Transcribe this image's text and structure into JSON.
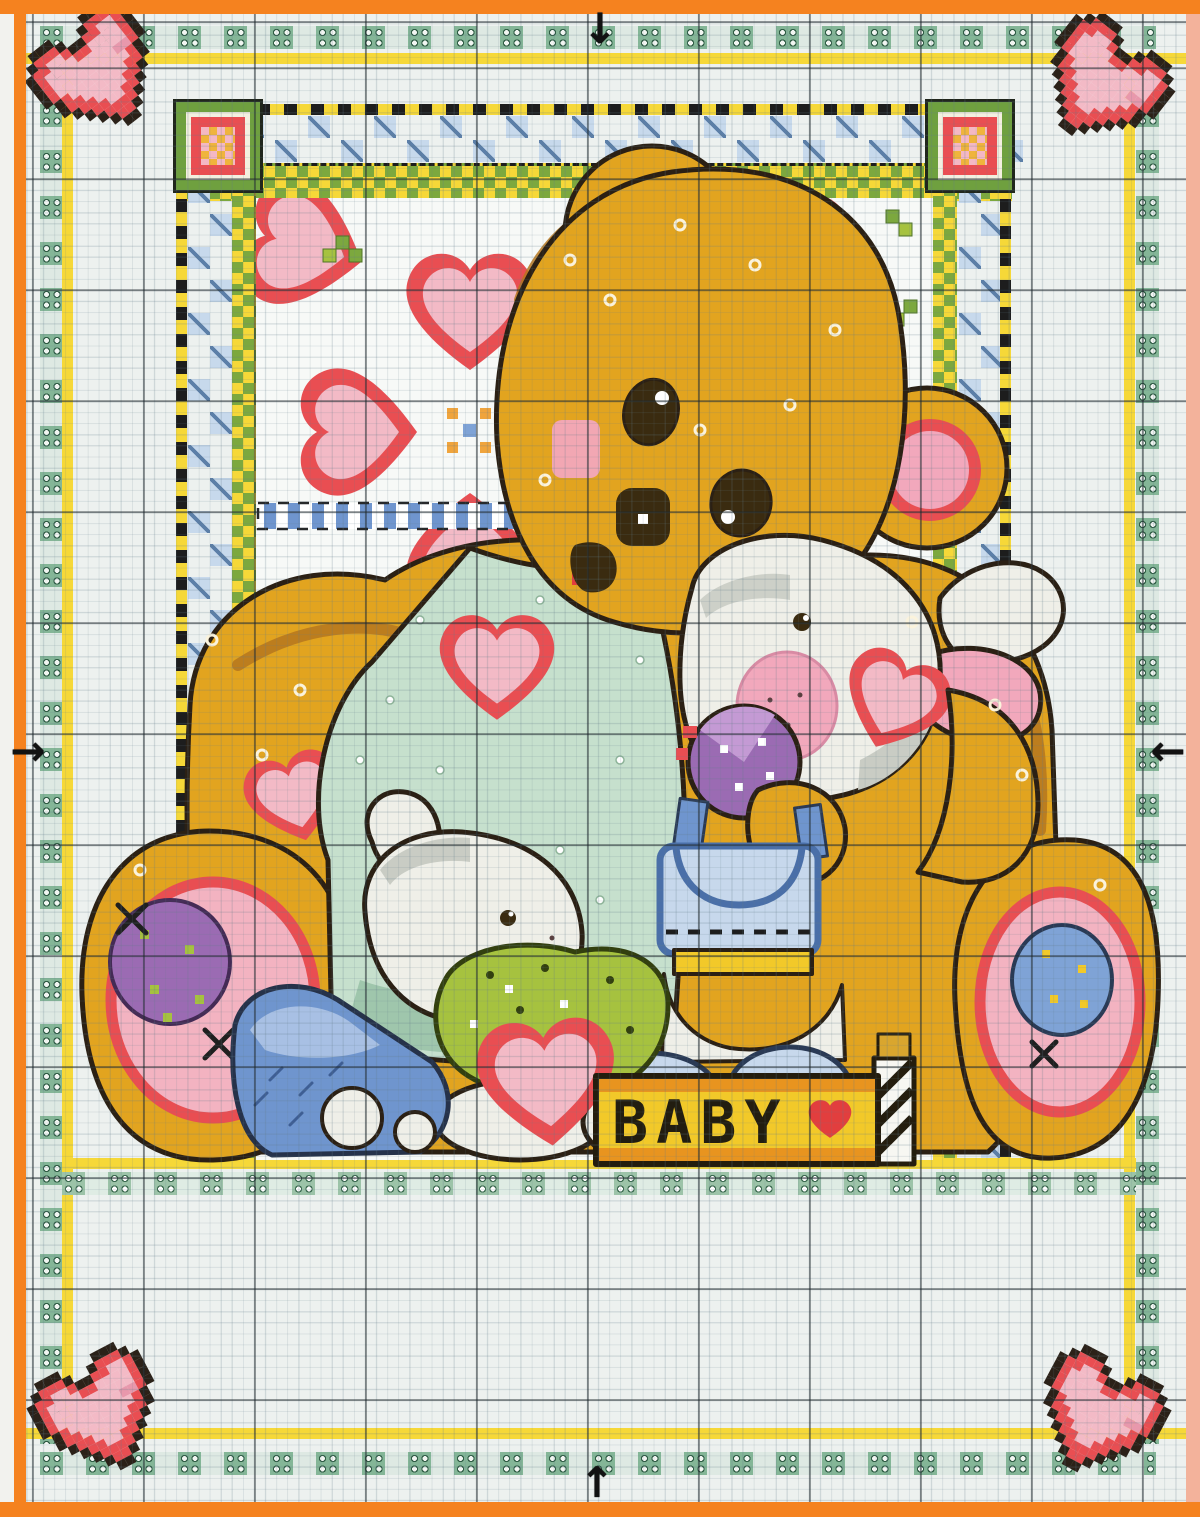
{
  "label_block": {
    "text": "BABY",
    "symbol": "red-heart"
  },
  "palette": {
    "orange": "#f5821f",
    "salmon": "#f3b29b",
    "sheet": "#edf1ef",
    "ooGreen": "#84b697",
    "yellow": "#f6d838",
    "zzBlue": "#c7d9ec",
    "ckGreen": "#7ca83e",
    "dark": "#2b2014",
    "gold": "#e2a41f",
    "goldShade": "#b5771f",
    "mint": "#c6e0cd",
    "mintShade": "#9fc6ac",
    "bunnyWhite": "#efefe8",
    "bunnyGray": "#c9ccc4",
    "earPink": "#f2a8bc",
    "padPink": "#f3b3c1",
    "heartRed": "#e94e52",
    "heartPink": "#f3bac6",
    "heartShade": "#e898ac",
    "eyeDark": "#3a2b10",
    "tongue": "#e23e3e",
    "purple": "#9b6bb3",
    "purpleLight": "#c49ad4",
    "lime": "#a6c23f",
    "limeDark": "#33400f",
    "blue": "#6f95ce",
    "blueLight": "#a8c0e4",
    "paleBlue": "#c7d8ec",
    "blockYellow": "#f2c929",
    "blockOrange": "#e8941f"
  },
  "heart_pixel_map": [
    "..KKK....KKK..",
    ".KRRRK..KRRRK.",
    "KRRPPRKKRRPPRK",
    "KRPPPPRRPPPPRK",
    "KRPPPPPPPPPPRK",
    "KRPPPPPPPPLLRK",
    ".KRPPPPPPPPRK.",
    ".KRRPPPPPPRRK.",
    "..KRRPPPPRRK..",
    "...KRRPPRRK...",
    "....KRRRRK....",
    ".....KRRK.....",
    "......KK......"
  ],
  "heart_cell_colors": {
    "K": "#2b2118",
    "R": "#e94e52",
    "P": "#f3bac6",
    "L": "#e898ac"
  },
  "corner_hearts": [
    {
      "pos": "top-left",
      "x": 36,
      "y": 16,
      "rot": -38
    },
    {
      "pos": "top-right",
      "x": 1038,
      "y": 26,
      "rot": 38
    },
    {
      "pos": "bottom-left",
      "x": 38,
      "y": 1356,
      "rot": -28
    },
    {
      "pos": "bottom-right",
      "x": 1034,
      "y": 1358,
      "rot": 28
    }
  ],
  "frame_squares": [
    {
      "pos": "top-left",
      "x": 176,
      "y": 102
    },
    {
      "pos": "top-right",
      "x": 928,
      "y": 102
    }
  ],
  "strips": [
    {
      "name": "oo-row-top",
      "type": "oo-h",
      "x": 40,
      "y": 26,
      "len": 1116
    },
    {
      "name": "oo-row-bottom",
      "type": "oo-h",
      "x": 40,
      "y": 1452,
      "len": 1116
    },
    {
      "name": "oo-col-left",
      "type": "oo-v",
      "x": 40,
      "y": 58,
      "len": 1386
    },
    {
      "name": "oo-col-right",
      "type": "oo-v",
      "x": 1136,
      "y": 58,
      "len": 1386
    },
    {
      "name": "yellow-line-top",
      "type": "yl-h",
      "x": 26,
      "y": 53,
      "len": 1160
    },
    {
      "name": "yellow-line-bottom",
      "type": "yl-h",
      "x": 26,
      "y": 1428,
      "len": 1160
    },
    {
      "name": "yellow-line-left",
      "type": "yl-v",
      "x": 62,
      "y": 53,
      "len": 1375
    },
    {
      "name": "yellow-line-right",
      "type": "yl-v",
      "x": 1124,
      "y": 53,
      "len": 1375
    },
    {
      "name": "frame-dash-top",
      "type": "dash-h",
      "x": 176,
      "y": 104,
      "len": 836
    },
    {
      "name": "frame-zigzag-top",
      "type": "zz-h",
      "x": 176,
      "y": 115,
      "len": 836
    },
    {
      "name": "frame-check-top",
      "type": "ck-h",
      "x": 176,
      "y": 163,
      "len": 836
    },
    {
      "name": "frame-dash-left",
      "type": "dash-v",
      "x": 176,
      "y": 104,
      "len": 1056
    },
    {
      "name": "frame-zigzag-left",
      "type": "zz-v",
      "x": 187,
      "y": 115,
      "len": 1040
    },
    {
      "name": "frame-check-left",
      "type": "ck-v",
      "x": 232,
      "y": 163,
      "len": 995
    },
    {
      "name": "frame-check-right",
      "type": "ck-v",
      "x": 933,
      "y": 163,
      "len": 995
    },
    {
      "name": "frame-zigzag-right",
      "type": "zz-v",
      "x": 958,
      "y": 115,
      "len": 1040
    },
    {
      "name": "frame-dash-right",
      "type": "dash-v",
      "x": 1000,
      "y": 104,
      "len": 1056
    },
    {
      "name": "picture-bottom-yellow",
      "type": "yl-h",
      "x": 62,
      "y": 1158,
      "len": 1074
    },
    {
      "name": "picture-bottom-oo",
      "type": "oo-mint-h",
      "x": 62,
      "y": 1172,
      "len": 1074
    }
  ],
  "center_marks": [
    {
      "dir": "down",
      "x": 600,
      "y": 30
    },
    {
      "dir": "up",
      "x": 597,
      "y": 1484
    },
    {
      "dir": "right",
      "x": 28,
      "y": 752
    },
    {
      "dir": "left",
      "x": 1168,
      "y": 752
    }
  ],
  "arrow_glyphs": {
    "down": "↓",
    "up": "↑",
    "left": "←",
    "right": "→"
  }
}
